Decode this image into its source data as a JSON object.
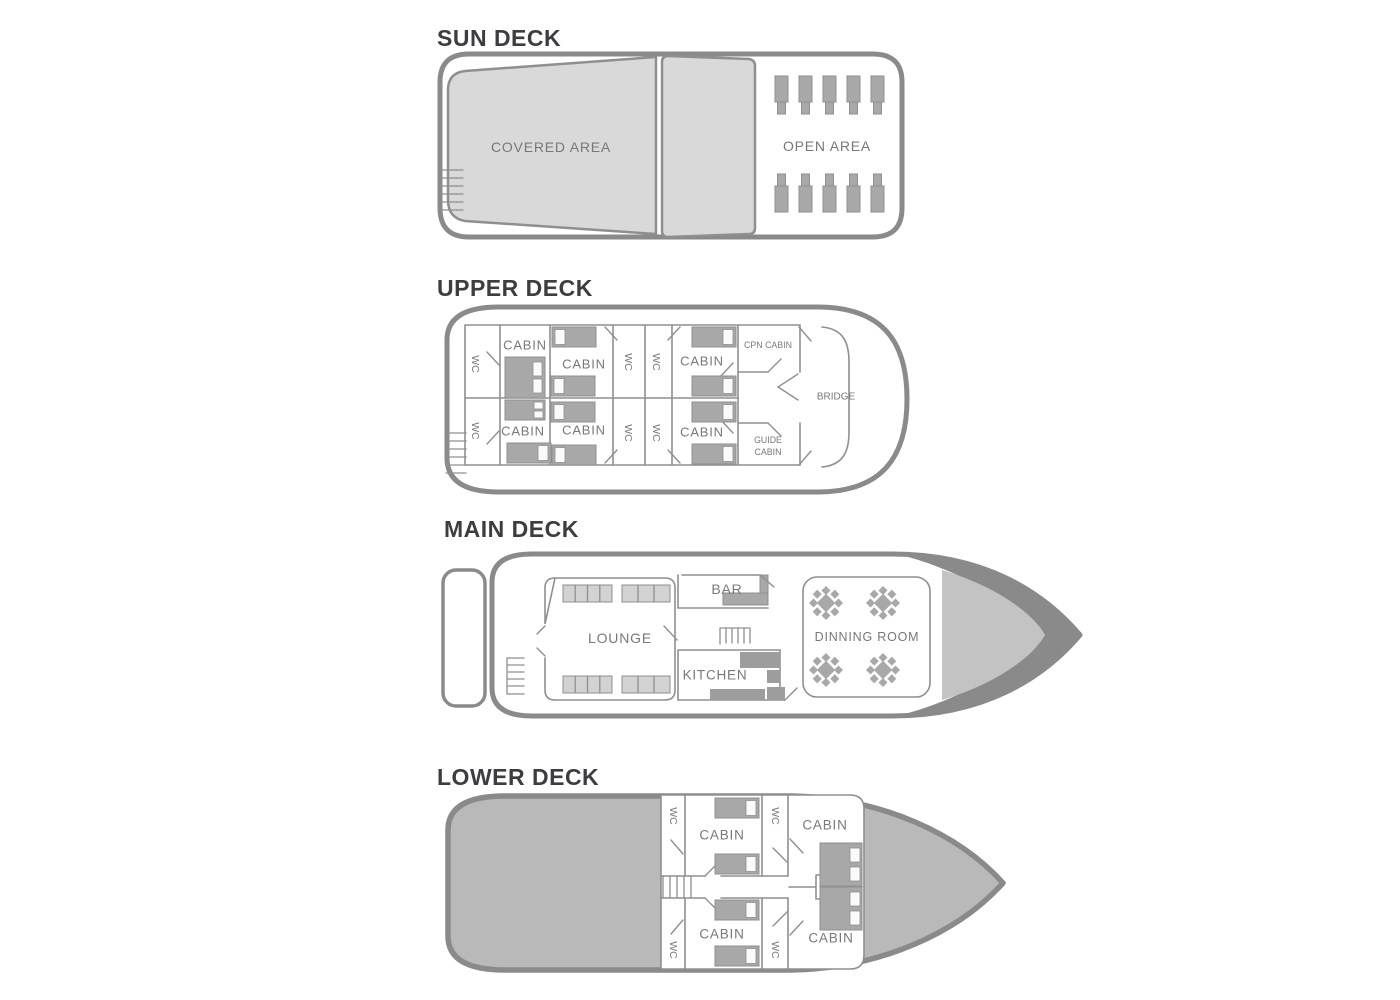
{
  "decks": {
    "sun": {
      "title": "SUN DECK",
      "covered_area": "COVERED AREA",
      "open_area": "OPEN AREA"
    },
    "upper": {
      "title": "UPPER DECK",
      "cabin": "CABIN",
      "wc": "WC",
      "cpn_cabin": "CPN CABIN",
      "guide_cabin_line1": "GUIDE",
      "guide_cabin_line2": "CABIN",
      "bridge": "BRIDGE"
    },
    "main": {
      "title": "MAIN DECK",
      "lounge": "LOUNGE",
      "bar": "BAR",
      "kitchen": "KITCHEN",
      "dining_room": "DINNING ROOM"
    },
    "lower": {
      "title": "LOWER DECK",
      "cabin": "CABIN",
      "wc": "WC"
    }
  },
  "colors": {
    "hull_outline": "#8a8a8a",
    "panel_fill": "#d9d9d9",
    "stern_bow_fill": "#b9b9b9",
    "bow_inner_fill": "#c3c3c3",
    "furniture_fill": "#a8a8a8",
    "label_text": "#77787b",
    "title_text": "#3d3d3f"
  }
}
